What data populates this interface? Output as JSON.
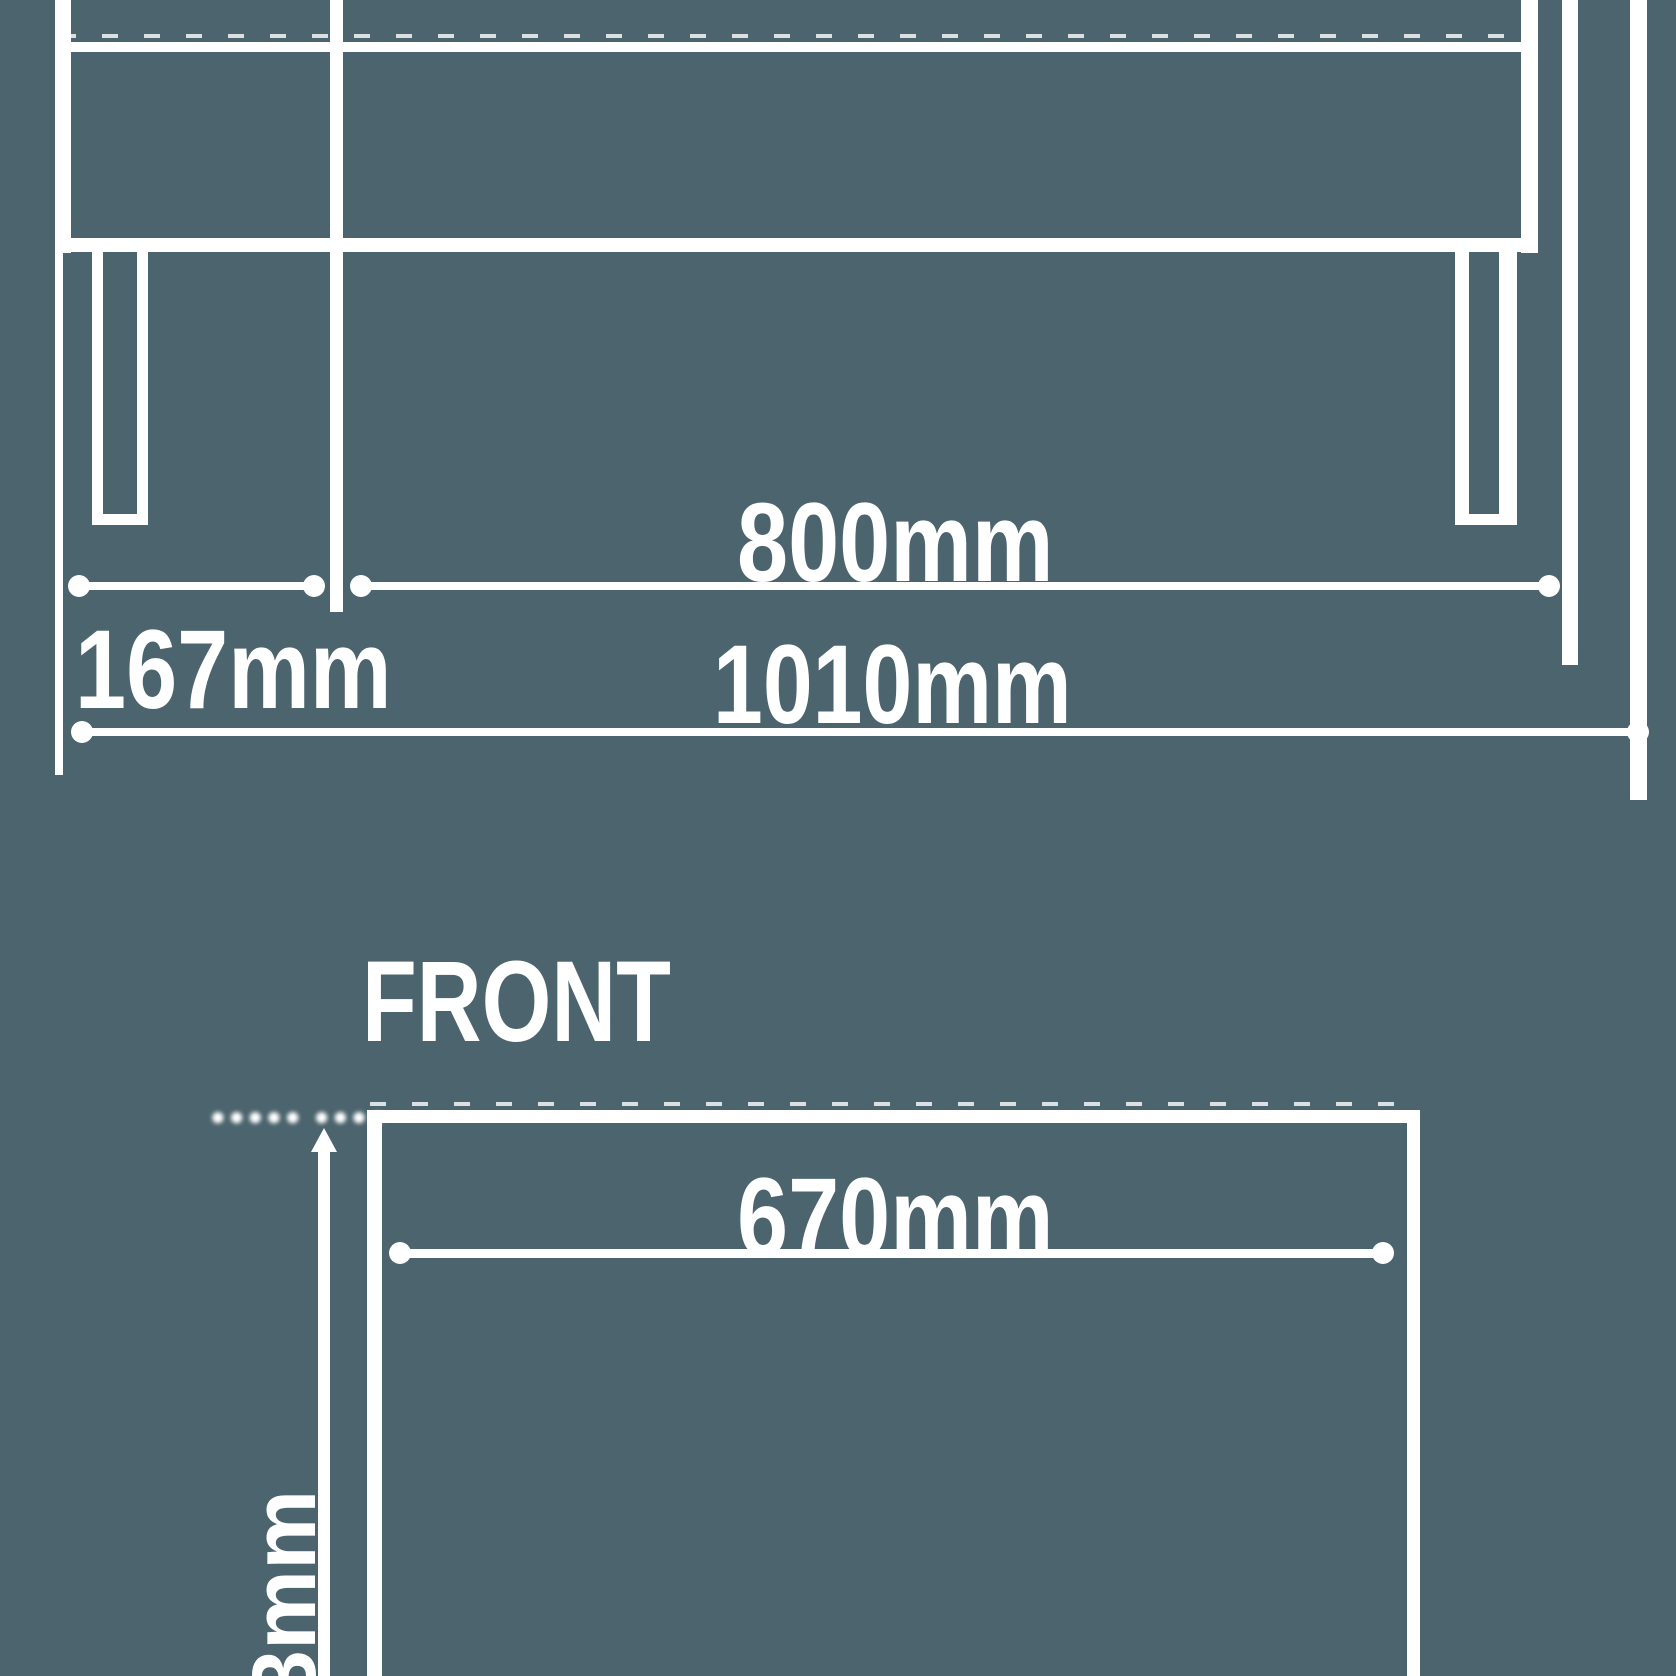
{
  "canvas": {
    "background_color": "#4c646d",
    "line_color": "#ffffff"
  },
  "top_view": {
    "description": "table-side-elevation-drawing",
    "dim_167": {
      "label": "167mm"
    },
    "dim_800": {
      "label": "800mm"
    },
    "dim_1010": {
      "label": "1010mm"
    }
  },
  "front_view": {
    "title": "FRONT",
    "dim_670": {
      "label": "670mm"
    },
    "dim_height_partial": {
      "label": "3mm"
    },
    "illegible_note": "●●●●● ●●●●"
  }
}
